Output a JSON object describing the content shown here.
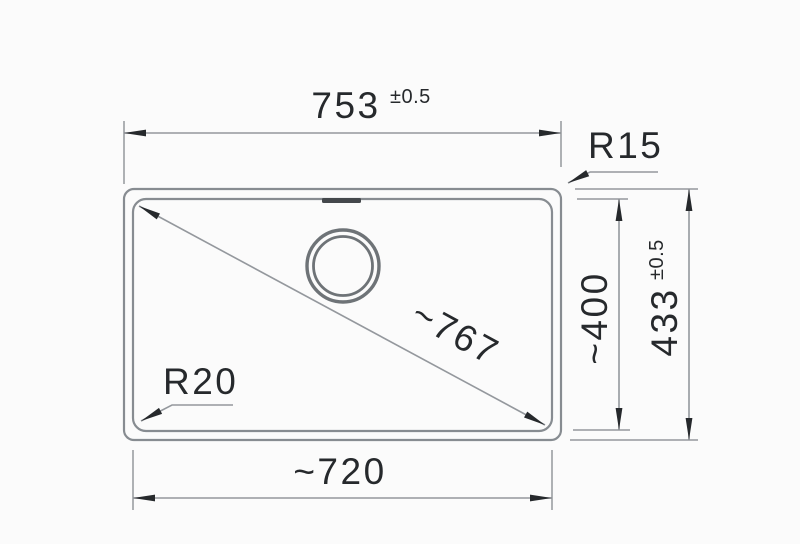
{
  "drawing": {
    "labels": {
      "top_width_value": "753",
      "top_width_tolerance": "±0.5",
      "radius_top_right": "R15",
      "inner_depth": "~400",
      "outer_depth_value": "433",
      "outer_depth_tolerance": "±0.5",
      "diagonal": "~767",
      "radius_bottom_left": "R20",
      "bottom_width": "~720"
    },
    "colors": {
      "background": "#fbfbfb",
      "object_line": "#878c91",
      "dimension_line": "#94989d",
      "arrow": "#26292c",
      "text": "#26292c",
      "overflow_slot": "#44484c",
      "drain_ring": "#6e7377"
    }
  }
}
